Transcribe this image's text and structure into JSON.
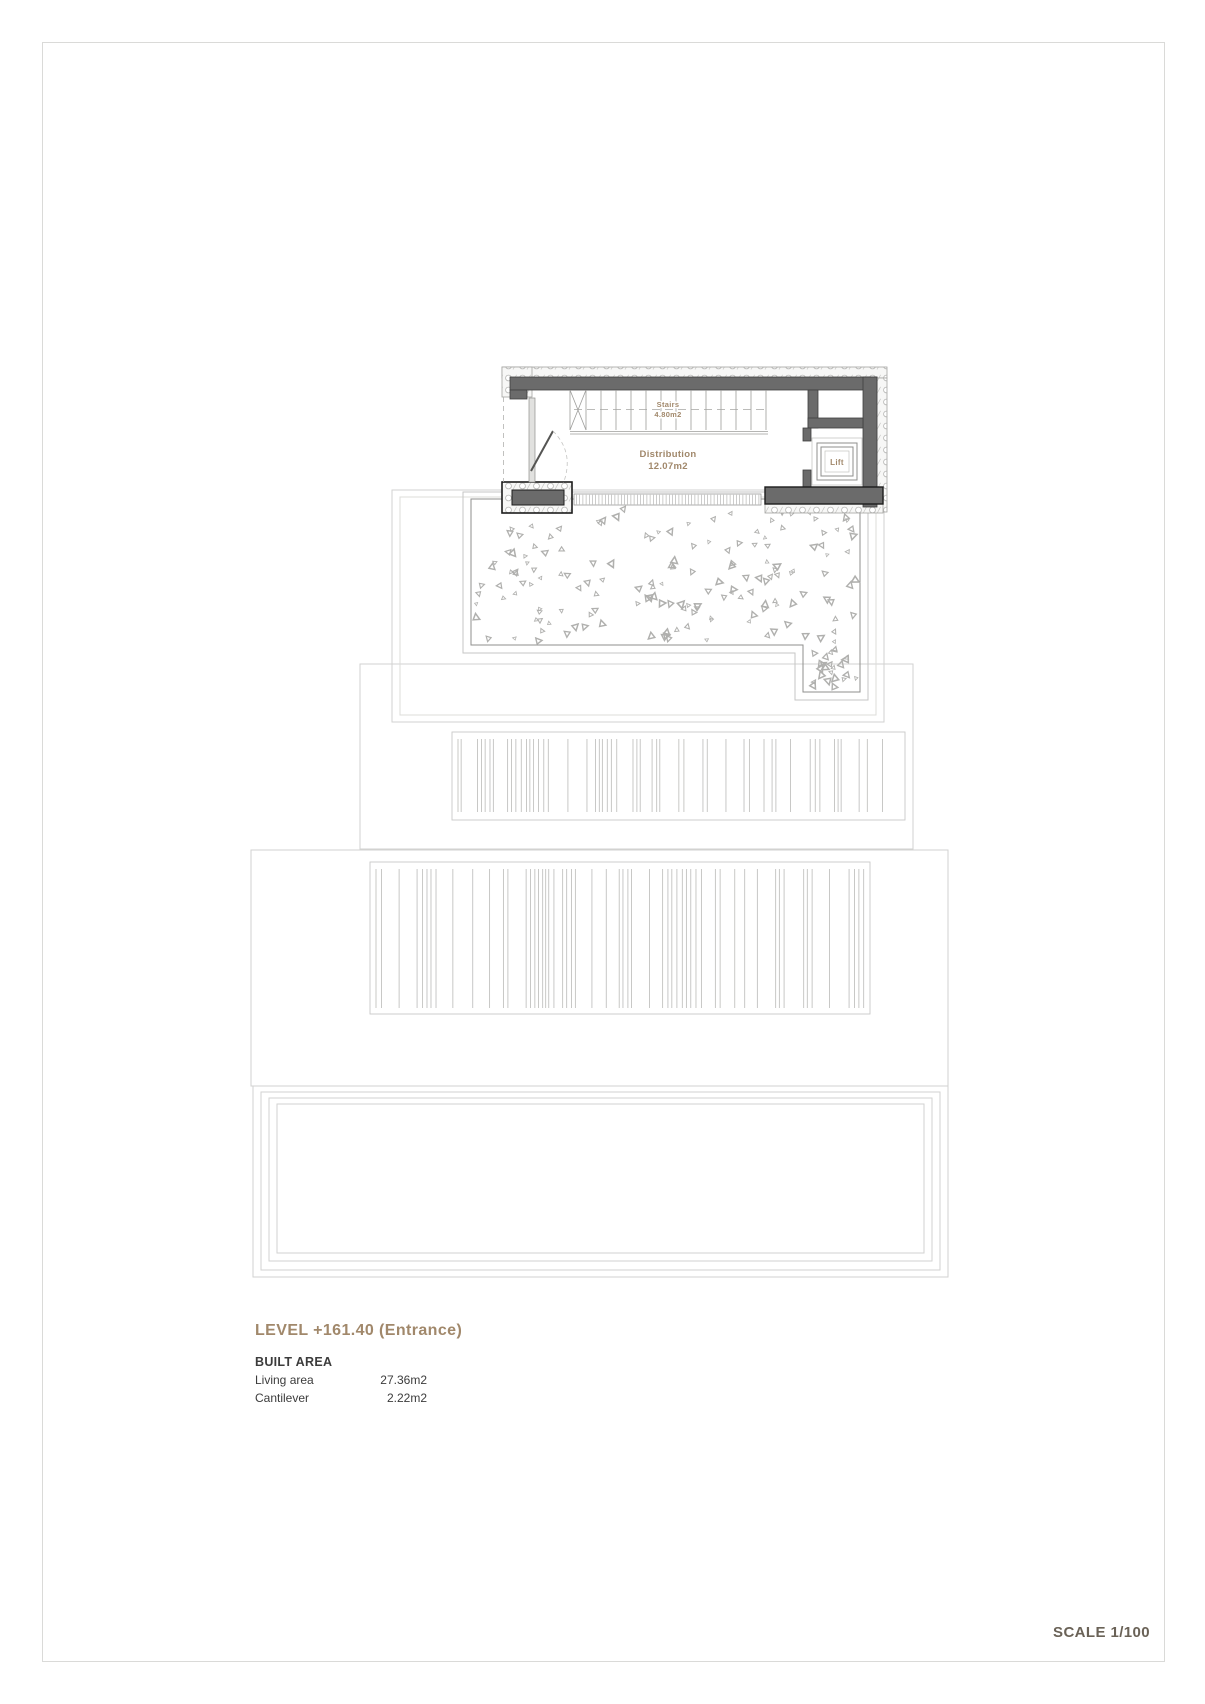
{
  "sheet": {
    "background": "#ffffff",
    "border_color": "#dadad8"
  },
  "plan": {
    "level": "+161.40",
    "labels": {
      "stairs_name": "Stairs",
      "stairs_area": "4.80m2",
      "distribution_name": "Distribution",
      "distribution_area": "12.07m2",
      "lift": "Lift"
    },
    "colors": {
      "wall": "#6b6b6b",
      "wall_edge": "#3f3f3f",
      "outline": "#1c1c1c",
      "room_label": "#a1886b",
      "thin_line": "#cfcfcd",
      "medium_line": "#9a9a9a",
      "stipple": "#b0b0ae",
      "slat_line": "#c2c2c0"
    }
  },
  "title_block": {
    "level_label": "LEVEL +161.40 (Entrance)",
    "built_area_heading": "BUILT AREA",
    "rows": [
      {
        "label": "Living area",
        "value": "27.36m2"
      },
      {
        "label": "Cantilever",
        "value": "2.22m2"
      }
    ]
  },
  "scale_label": "SCALE 1/100"
}
